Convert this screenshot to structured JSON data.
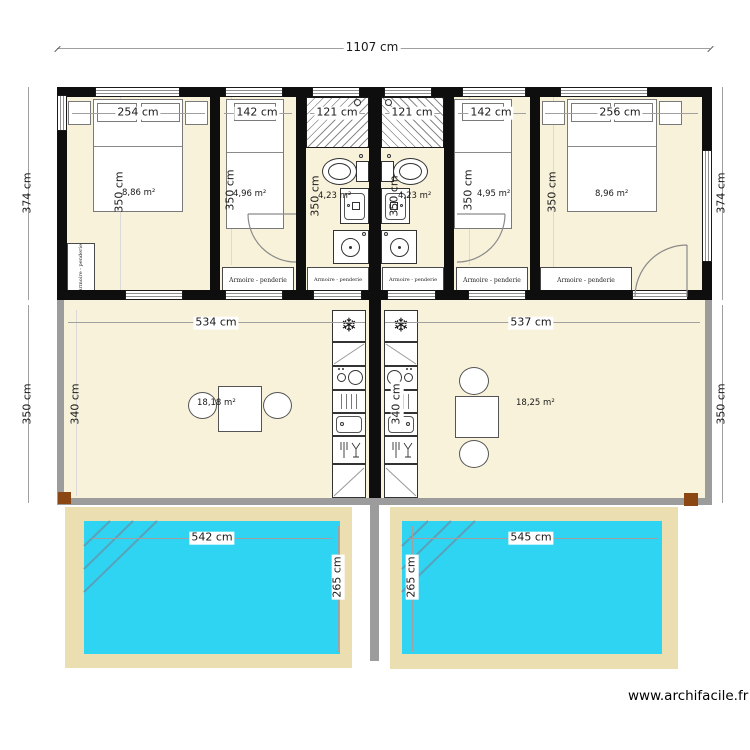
{
  "dims": {
    "total_width": "1107 cm",
    "top_band_left": "374 cm",
    "top_band_right": "374 cm",
    "mid_band_left": "350 cm",
    "mid_band_right": "350 cm"
  },
  "bedrooms": {
    "r1": {
      "width": "254 cm",
      "depth": "350 cm",
      "area": "8,86 m²",
      "closet": "Armoire - penderie"
    },
    "r2": {
      "width": "142 cm",
      "depth": "350 cm",
      "area": "4,96 m²",
      "closet": "Armoire - penderie"
    },
    "b1": {
      "width": "121 cm",
      "depth": "350 cm",
      "area": "4,23 m²",
      "closet": "Armoire - penderie"
    },
    "b2": {
      "width": "121 cm",
      "depth": "350 cm",
      "area": "4,23 m²",
      "closet": "Armoire - penderie"
    },
    "r3": {
      "width": "142 cm",
      "depth": "350 cm",
      "area": "4,95 m²",
      "closet": "Armoire - penderie"
    },
    "r4": {
      "width": "256 cm",
      "depth": "350 cm",
      "area": "8,96 m²",
      "closet": "Armoire - penderie"
    }
  },
  "living": {
    "left": {
      "width": "534 cm",
      "interior_depth": "340 cm",
      "area": "18,18 m²"
    },
    "right": {
      "width": "537 cm",
      "interior_depth": "340 cm",
      "area": "18,25 m²"
    }
  },
  "pools": {
    "left": {
      "width": "542 cm",
      "depth": "265 cm"
    },
    "right": {
      "width": "545 cm",
      "depth": "265 cm"
    }
  },
  "icons": {
    "fridge": "❄"
  },
  "watermark": "www.archifacile.fr",
  "colors": {
    "floor": "#f7f2d9",
    "wall": "#0e0e0e",
    "living_wall": "#9c9c9c",
    "pool": "#2fd4f2",
    "terrace": "#ebdfb2",
    "post": "#8a4613"
  }
}
